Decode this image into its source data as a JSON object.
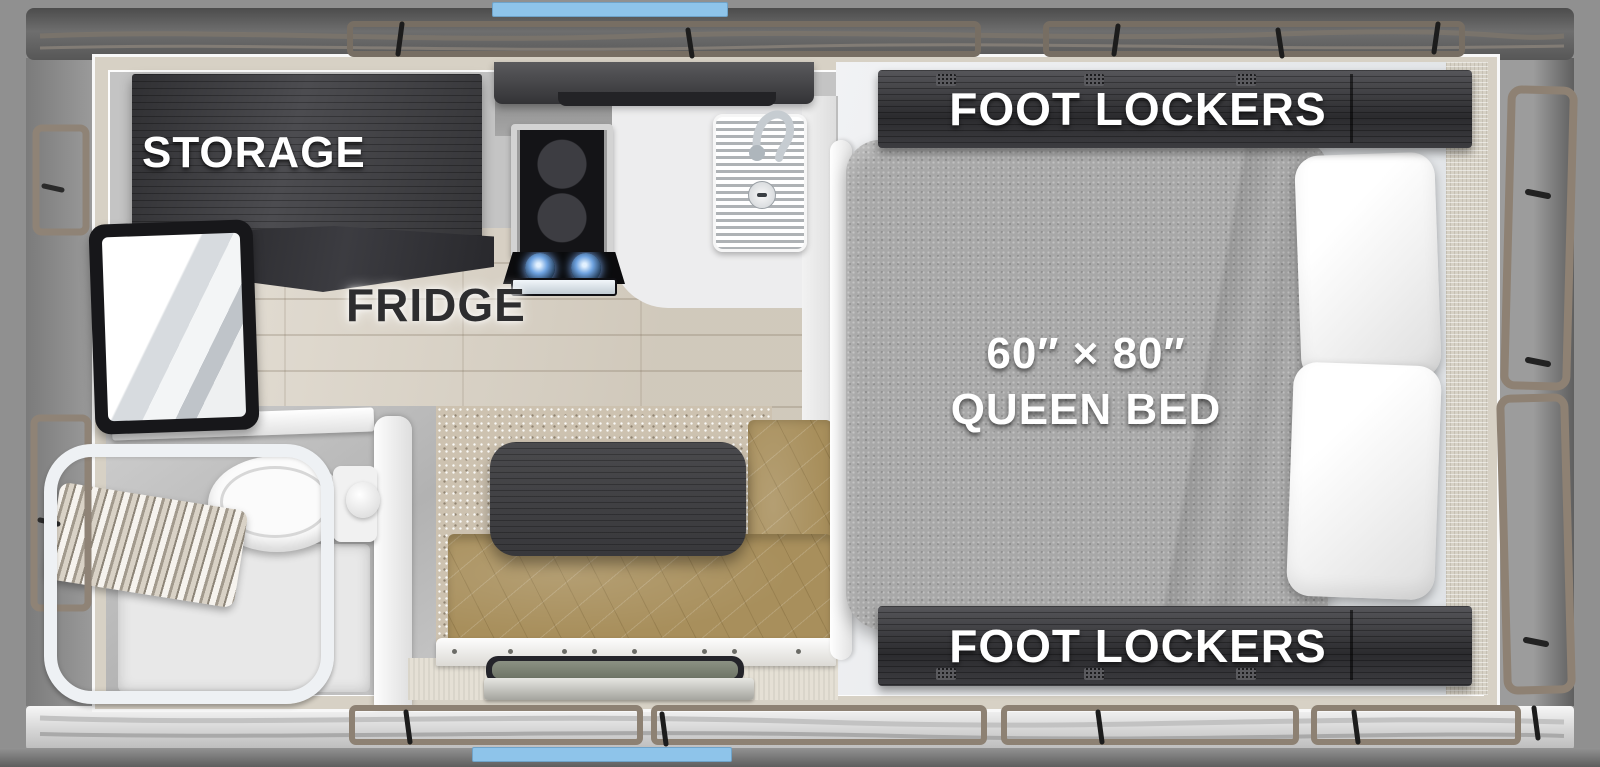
{
  "floorplan": {
    "type": "truck-camper top-down floor plan rendering",
    "labels": {
      "storage": "STORAGE",
      "fridge": "FRIDGE",
      "foot_lockers_top": "FOOT LOCKERS",
      "foot_lockers_bottom": "FOOT LOCKERS",
      "bed_dimensions": "60″ × 80″",
      "bed_type": "QUEEN BED"
    },
    "fixtures": [
      "storage-cabinet",
      "refrigerator",
      "tv",
      "overhead-cabinet",
      "cooktop-stove",
      "kitchen-sink",
      "faucet",
      "shower",
      "shower-curtain",
      "toilet",
      "dinette-table",
      "dinette-bench",
      "entry-step",
      "queen-bed",
      "pillows",
      "foot-lockers"
    ],
    "colors": {
      "accent_blue": "#8EC4EA",
      "cabinet_dark_wood": "#39393C",
      "bench_leather_tan": "#A88F5C",
      "bed_fabric_gray": "#A8A8A8",
      "floor_wood_beige": "#D9D1C3",
      "carpet_speckle": "#CDC2B0",
      "exterior_gray": "#8A8A8A",
      "trim_taupe": "#8D8173",
      "label_white": "#FFFFFF",
      "label_dark": "#2D2D2F"
    }
  }
}
